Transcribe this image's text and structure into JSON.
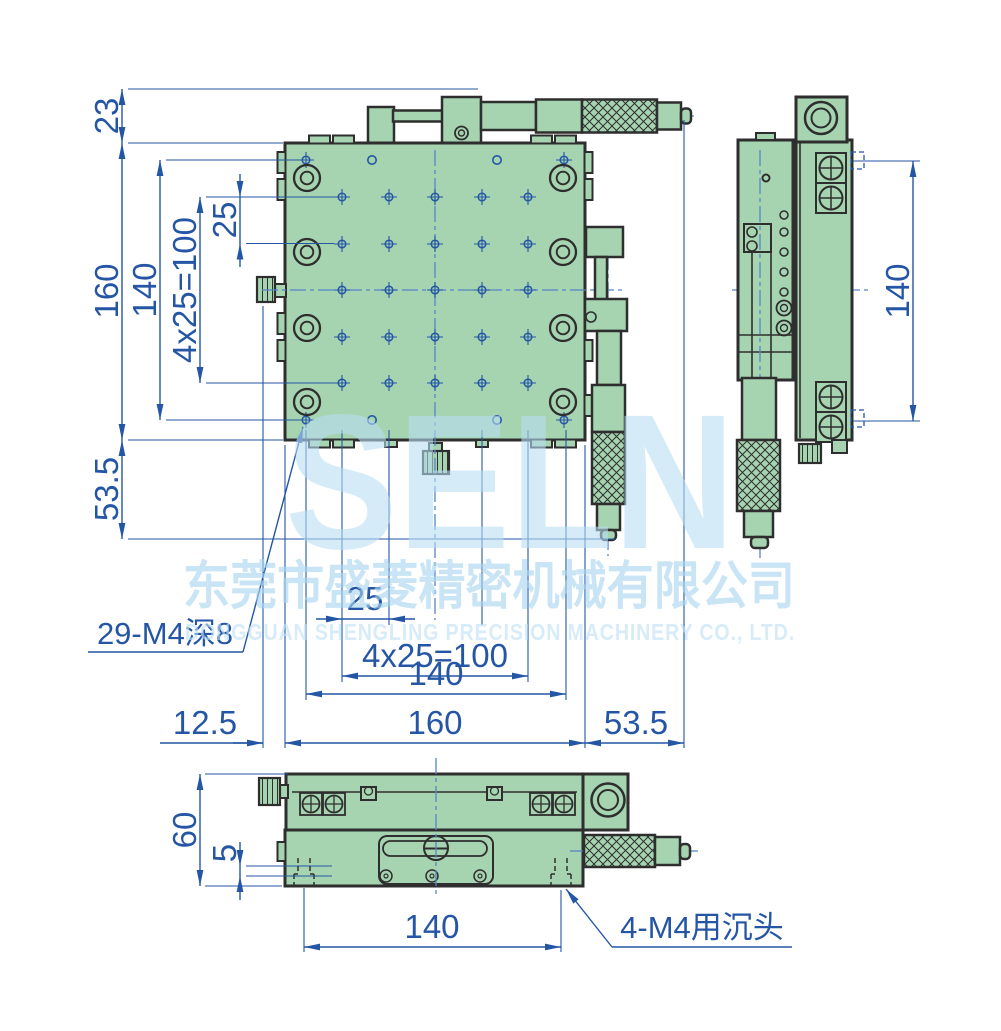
{
  "drawing": {
    "watermark": {
      "logo": "SELN",
      "company_cn": "东莞市盛菱精密机械有限公司",
      "company_en": "DONGGUAN SHENGLING PRECISION MACHINERY CO., LTD."
    },
    "plan_view": {
      "dim_top_offset": "23",
      "dim_height": "160",
      "dim_hole_span_v": "140",
      "dim_pitch_v": "4x25=100",
      "dim_pitch_single_v": "25",
      "dim_bottom_overhang": "53.5",
      "label_thread_holes": "29-M4深8",
      "dim_pitch_single_h": "25",
      "dim_pitch_h": "4x25=100",
      "dim_hole_span_h": "140",
      "dim_width": "160",
      "dim_left_offset": "12.5",
      "dim_right_overhang": "53.5"
    },
    "side_view": {
      "dim_height": "140"
    },
    "front_view": {
      "dim_height": "60",
      "dim_base_plate": "5",
      "dim_mount_span": "140",
      "label_counterbore": "4-M4用沉头"
    },
    "colors": {
      "body": "#a6d4b0",
      "outline": "#2e2e2e",
      "dimension": "#2456a5",
      "watermark": "#b9def4"
    }
  }
}
